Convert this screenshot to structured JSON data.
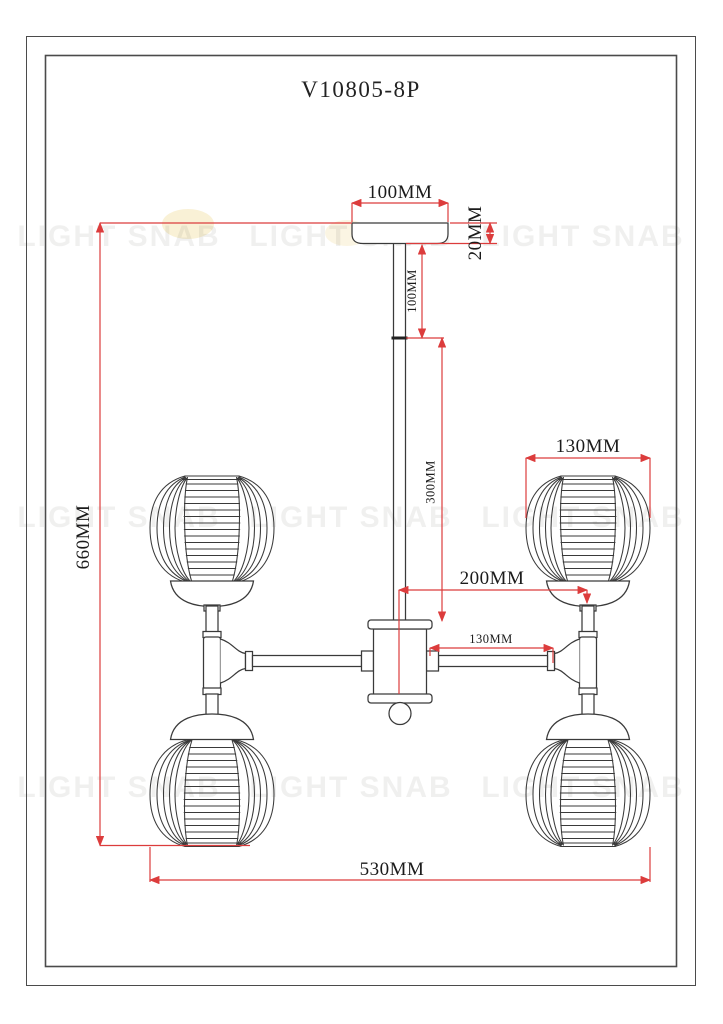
{
  "title": "V10805-8P",
  "watermark": {
    "text": "LIGHT SNAB"
  },
  "colors": {
    "dim_red": "#dc3c3c",
    "ink": "#3a3a3a",
    "label": "#1b1b1b",
    "frame": "#4b4b4b",
    "watermark_tint": "rgba(70,60,45,0.08)",
    "accent_yellow": "#ecd37e"
  },
  "dims": {
    "canopy_width": "100MM",
    "canopy_height": "20MM",
    "rod_upper": "100MM",
    "rod_lower": "300MM",
    "overall_height": "660MM",
    "shade_diameter": "130MM",
    "hub_to_shade": "200MM",
    "arm_length": "130MM",
    "overall_width": "530MM"
  }
}
